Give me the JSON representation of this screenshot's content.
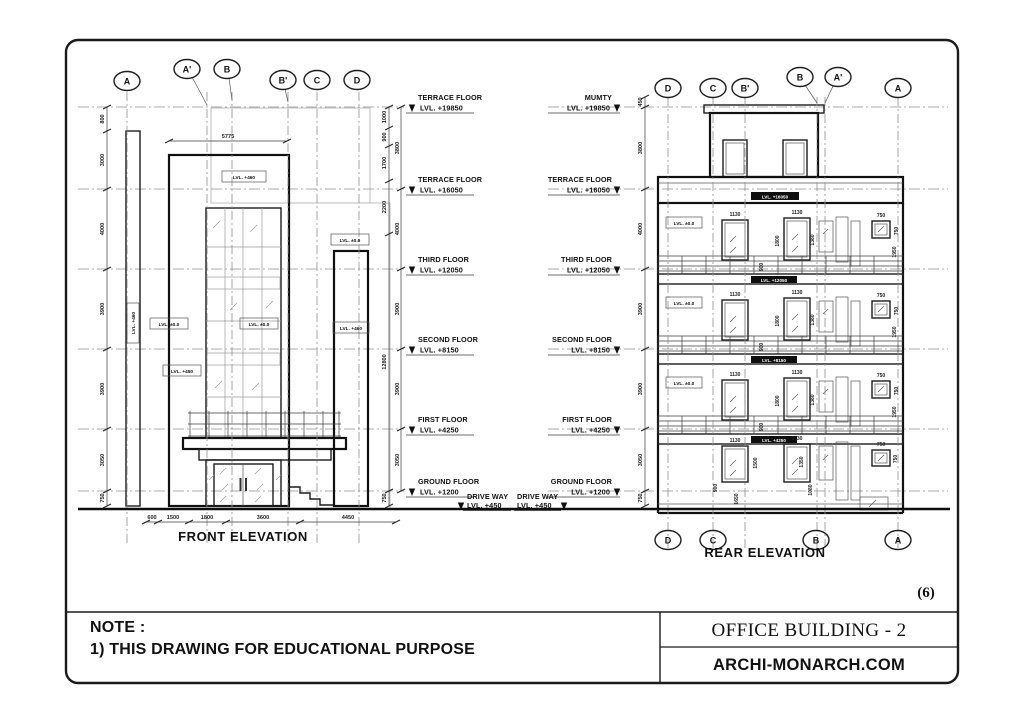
{
  "page": {
    "number": "(6)"
  },
  "titleblock": {
    "note_title": "NOTE :",
    "note_line": "1) THIS DRAWING FOR EDUCATIONAL PURPOSE",
    "project": "OFFICE BUILDING - 2",
    "website": "ARCHI-MONARCH.COM"
  },
  "front": {
    "title": "FRONT ELEVATION",
    "bubbles": {
      "A": "A",
      "A1": "A'",
      "B": "B",
      "B1": "B'",
      "C": "C",
      "D": "D"
    },
    "levels": [
      {
        "name": "TERRACE FLOOR",
        "lvl": "LVL. +19850"
      },
      {
        "name": "TERRACE FLOOR",
        "lvl": "LVL. +16050"
      },
      {
        "name": "THIRD FLOOR",
        "lvl": "LVL. +12050"
      },
      {
        "name": "SECOND FLOOR",
        "lvl": "LVL. +8150"
      },
      {
        "name": "FIRST FLOOR",
        "lvl": "LVL. +4250"
      },
      {
        "name": "GROUND FLOOR",
        "lvl": "LVL. +1200"
      }
    ],
    "driveway": {
      "name": "DRIVE WAY",
      "lvl": "LVL. +450"
    },
    "dim_top": "5775",
    "dims_left": [
      "800",
      "3000",
      "4000",
      "3900",
      "3900",
      "3050",
      "750"
    ],
    "dims_right_inner": [
      "1000",
      "900",
      "1700",
      "2200",
      "12800",
      "750"
    ],
    "dims_right_outer": [
      "3800",
      "4000",
      "3900",
      "3900",
      "3050"
    ],
    "dims_bottom": [
      "600",
      "1500",
      "1800",
      "3600",
      "4450"
    ],
    "tags": {
      "parapet": "LVL. +460",
      "pillar": "LVL. +460",
      "mid_left": "LVL. ±0.0",
      "glass": "LVL. ±0.0",
      "plinth": "LVL. +450",
      "col_top": "LVL. ±0.0",
      "col_mid": "LVL. +460"
    }
  },
  "rear": {
    "title": "REAR ELEVATION",
    "bubbles_top": {
      "D": "D",
      "C": "C",
      "B1": "B'",
      "B": "B",
      "A1": "A'",
      "A": "A"
    },
    "bubbles_bottom": {
      "D": "D",
      "C": "C",
      "B": "B",
      "A": "A"
    },
    "levels": [
      {
        "name": "MUMTY",
        "lvl": "LVL. +19850"
      },
      {
        "name": "TERRACE FLOOR",
        "lvl": "LVL. +16050"
      },
      {
        "name": "THIRD FLOOR",
        "lvl": "LVL. +12050"
      },
      {
        "name": "SECOND FLOOR",
        "lvl": "LVL. +8150"
      },
      {
        "name": "FIRST FLOOR",
        "lvl": "LVL. +4250"
      },
      {
        "name": "GROUND FLOOR",
        "lvl": "LVL. +1200"
      }
    ],
    "driveway": {
      "name": "DRIVE WAY",
      "lvl": "LVL. +450"
    },
    "dims_left": [
      "450",
      "3800",
      "4000",
      "3900",
      "3900",
      "3050",
      "750"
    ],
    "band_labels": [
      "LVL. +16050",
      "LVL. +12050",
      "LVL. +8150",
      "LVL. +4250"
    ],
    "unit_tag": "LVL. ±0.0",
    "win": {
      "w1": "1130",
      "w2": "1130",
      "small": "750",
      "h1": "1800",
      "h2": "1380",
      "rail": "900",
      "side": "1950",
      "small_h": "750"
    },
    "ground_dims": {
      "d900": "900",
      "d1650": "1650",
      "d1500": "1500",
      "d1350": "1350",
      "d1080": "1080",
      "d750": "750"
    }
  }
}
